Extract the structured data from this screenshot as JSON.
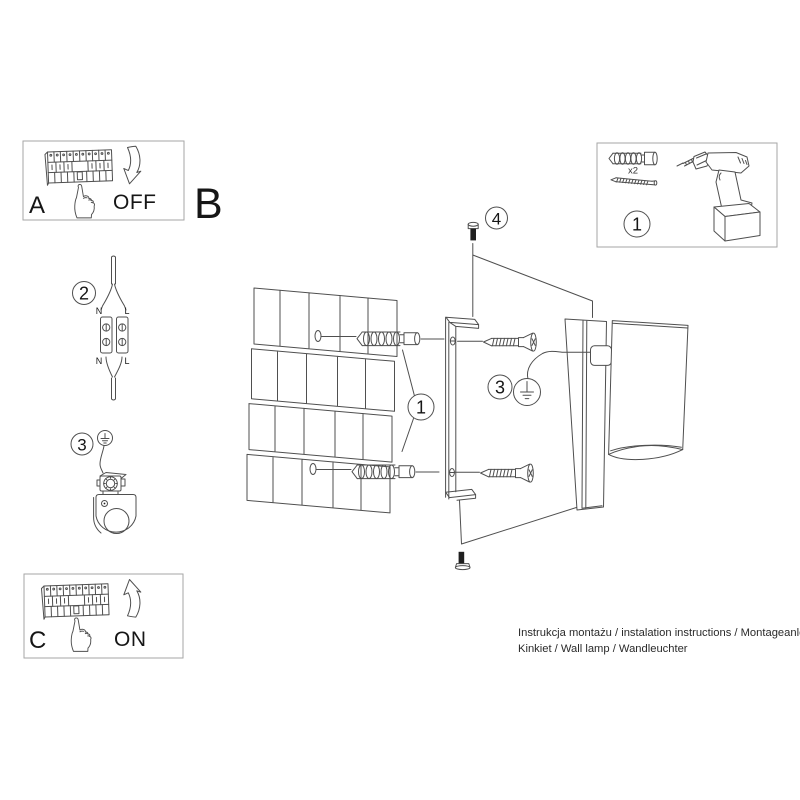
{
  "sheet": {
    "background": "#ffffff",
    "ink_color": "#4f4f4f",
    "border_color": "#a6a6a6",
    "text_color": "#161616"
  },
  "panel_a": {
    "label": "A",
    "state": "OFF"
  },
  "panel_b": {
    "label": "B"
  },
  "panel_c": {
    "label": "C",
    "state": "ON"
  },
  "panel_tools": {
    "number": "1",
    "anchor_qty": "x2"
  },
  "step2": {
    "number": "2",
    "labels": {
      "n_top": "N",
      "l_top": "L",
      "n_bottom": "N",
      "l_bottom": "L"
    }
  },
  "step3_detail": {
    "number": "3"
  },
  "main": {
    "anchor_step": "1",
    "ground_step": "3",
    "screw_step": "4"
  },
  "footer": {
    "line1": "Instrukcja montażu / instalation instructions / Montageanleitung",
    "line2": "Kinkiet / Wall lamp / Wandleuchter"
  }
}
